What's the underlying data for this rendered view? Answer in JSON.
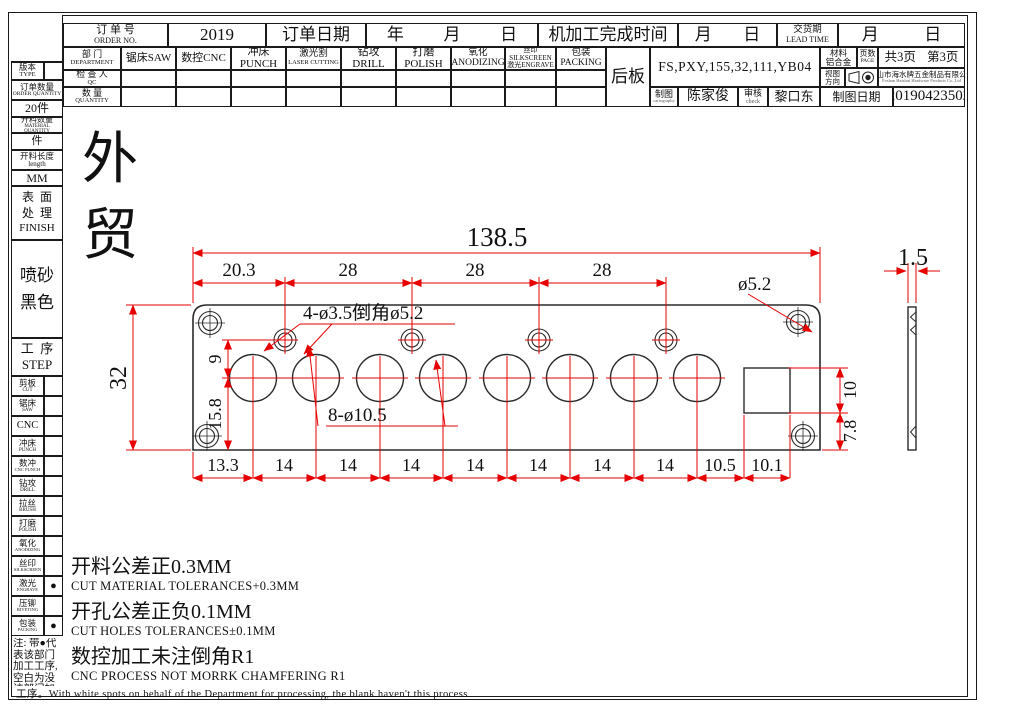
{
  "header": {
    "order_label_cn": "订 单 号",
    "order_label_en": "ORDER NO.",
    "order_value": "2019",
    "order_date_label": "订单日期",
    "year": "年",
    "month": "月",
    "day": "日",
    "machining_label": "机加工完成时间",
    "lead_label_cn": "交货期",
    "lead_label_en": "LEAD TIME"
  },
  "departments": {
    "label_cn": "部 门",
    "label_en": "DEPARTMENT",
    "cols": [
      {
        "l1": "锯床SAW",
        "l2": ""
      },
      {
        "l1": "数控CNC",
        "l2": ""
      },
      {
        "l1": "冲床PUNCH",
        "l2": ""
      },
      {
        "l1": "激光割",
        "l2": "LASER CUTTING"
      },
      {
        "l1": "钻攻DRILL",
        "l2": ""
      },
      {
        "l1": "打磨POLISH",
        "l2": ""
      },
      {
        "l1": "氧化ANODIZING",
        "l2": ""
      },
      {
        "l1": "丝印SILKSCREEN",
        "l2": "激光ENGRAVE"
      },
      {
        "l1": "包装PACKING",
        "l2": ""
      }
    ],
    "qc_label_cn": "检 查 人",
    "qc_label_en": "QC",
    "qty_label_cn": "数 量",
    "qty_label_en": "QUANTITY"
  },
  "title_block": {
    "part_name": "后板",
    "product_code": "FS,PXY,155,32,111,YB04",
    "material_label": "材料",
    "material_value": "铝合金",
    "pages_label": "页数",
    "pages_label_en": "PAGE",
    "pages_total": "共3页",
    "page_current": "第3页",
    "view_label_l1": "视图",
    "view_label_l2": "方向",
    "company_cn": "佛山市海水牌五金制品有限公司",
    "company_en": "Foshan Haishui Hardware Products Co.,Ltd",
    "drawn_label": "制图",
    "drawn_sub": "cartography",
    "drawn_by": "陈家俊",
    "check_label": "审核",
    "check_sub": "check",
    "checked_by": "黎口东",
    "date_label": "制图日期",
    "date_value": "20190423502"
  },
  "sidebar": {
    "version_label": "版本",
    "version_en": "TYPE",
    "order_qty_label": "订单数量",
    "order_qty_en": "ORDER QUANTITY",
    "order_qty_value": "20件",
    "material_qty_label": "开料数量",
    "material_qty_en": "MATERIAL QUANTITY",
    "material_qty_value": "件",
    "length_label": "开料长度",
    "length_en": "length",
    "length_value": "MM",
    "finish_label_l1": "表  面",
    "finish_label_l2": "处  理",
    "finish_en": "FINISH",
    "finish_value_l1": "喷砂",
    "finish_value_l2": "黑色",
    "step_label": "工  序",
    "step_en": "STEP",
    "steps": [
      {
        "cn": "剪板",
        "en": "CUT",
        "dot": ""
      },
      {
        "cn": "锯床",
        "en": "SAW",
        "dot": ""
      },
      {
        "cn": "CNC",
        "en": "",
        "dot": ""
      },
      {
        "cn": "冲床",
        "en": "PUNCH",
        "dot": ""
      },
      {
        "cn": "数冲",
        "en": "CNC PUNCH",
        "dot": ""
      },
      {
        "cn": "钻攻",
        "en": "DRILL",
        "dot": ""
      },
      {
        "cn": "拉丝",
        "en": "BRUSH",
        "dot": ""
      },
      {
        "cn": "打磨",
        "en": "POLISH",
        "dot": ""
      },
      {
        "cn": "氧化",
        "en": "ANODIZING",
        "dot": ""
      },
      {
        "cn": "丝印",
        "en": "SILKSCREEN",
        "dot": ""
      },
      {
        "cn": "激光",
        "en": "ENGRAVE",
        "dot": "●"
      },
      {
        "cn": "压铆",
        "en": "RIVETING",
        "dot": ""
      },
      {
        "cn": "包装",
        "en": "PACKING",
        "dot": "●"
      }
    ],
    "note": "注: 带●代表该部门加工工序, 空白为没该部门加工工序。"
  },
  "main": {
    "trade_mark": "外贸",
    "notes": [
      {
        "cn": "开料公差正0.3MM",
        "en": "CUT MATERIAL TOLERANCES+0.3MM"
      },
      {
        "cn": "开孔公差正负0.1MM",
        "en": "CUT HOLES TOLERANCES±0.1MM"
      },
      {
        "cn": "数控加工未注倒角R1",
        "en": "CNC PROCESS NOT MORRK CHAMFERING R1"
      }
    ],
    "footer": "工序。With white spots on behalf of the Department for processing, the blank haven't this process"
  },
  "dims": {
    "total_width": "138.5",
    "top_chain": [
      "20.3",
      "28",
      "28",
      "28"
    ],
    "corner_hole": "ø5.2",
    "small_holes_note": "4-ø3.5倒角ø5.2",
    "big_holes_note": "8-ø10.5",
    "height_total": "32",
    "height_upper": "9",
    "height_lower": "15.8",
    "notch_height": "10",
    "notch_bottom": "7.8",
    "bottom_chain": [
      "13.3",
      "14",
      "14",
      "14",
      "14",
      "14",
      "14",
      "14",
      "10.5",
      "10.1"
    ],
    "thickness": "1.5"
  },
  "colors": {
    "dimension": "#e60000",
    "line": "#222222"
  }
}
